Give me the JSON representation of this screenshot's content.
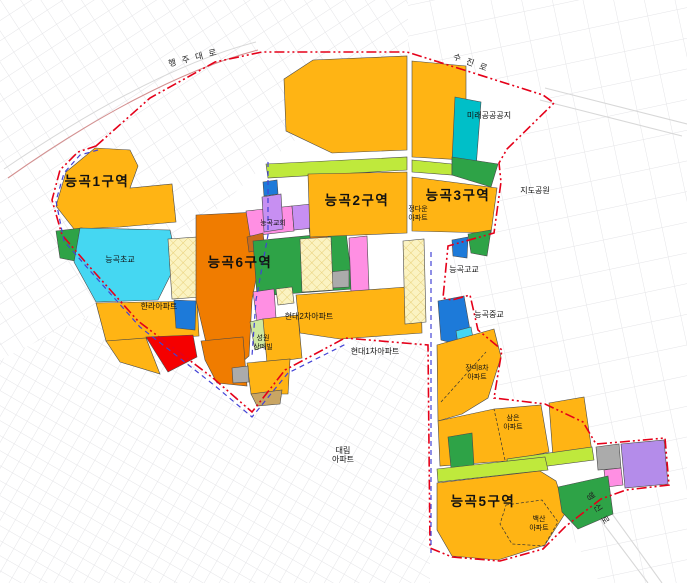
{
  "map": {
    "zones": [
      {
        "id": "1",
        "label": "능곡1구역"
      },
      {
        "id": "2",
        "label": "능곡2구역"
      },
      {
        "id": "3",
        "label": "능곡3구역"
      },
      {
        "id": "5",
        "label": "능곡5구역"
      },
      {
        "id": "6",
        "label": "능곡6구역"
      }
    ],
    "places": {
      "mirae": "미래공공공지",
      "jido_park": "지도공원",
      "church": "능곡교회",
      "elementary": "능곡초교",
      "high_school": "능곡고교",
      "middle_school": "능곡중교",
      "hanla": "한라아파트",
      "hyundai2": "현대2차아파트",
      "hyundai1": "현대1차아파트",
      "jeongdawoon_1": "정다운",
      "jeongdawoon_2": "아파트",
      "sungwon_1": "성원",
      "sungwon_2": "상떼빌",
      "jangmi_1": "장미8차",
      "jangmi_2": "아파트",
      "sameun_1": "삼은",
      "sameun_2": "아파트",
      "daerim_1": "대림",
      "daerim_2": "아파트",
      "baeksan_1": "백산",
      "baeksan_2": "아파트"
    },
    "roads": {
      "haengju": "행주대로",
      "sujin": "수진로",
      "haengsin": "행신로"
    }
  },
  "colors": {
    "amber": "#FFB414",
    "orange": "#F07C00",
    "red": "#F50000",
    "cyan": "#45D7F2",
    "teal": "#00BFC8",
    "green": "#2EA347",
    "chartreuse": "#BFE93C",
    "pale_green": "#CFE8A0",
    "pink": "#FF8FE3",
    "violet": "#C78FF2",
    "purple": "#B48CEA",
    "blue": "#1D7AD9",
    "gray": "#ABABAB",
    "tan": "#C9A563",
    "brown": "#C96A1B",
    "cream": "#FBF3C2",
    "hatch_line": "#E3C766",
    "boundary_red": "#E50019",
    "boundary_blue": "#4343D6",
    "road_pink": "#D49090",
    "road_gray": "#D8D8D8",
    "grid": "#E4E4E7"
  }
}
